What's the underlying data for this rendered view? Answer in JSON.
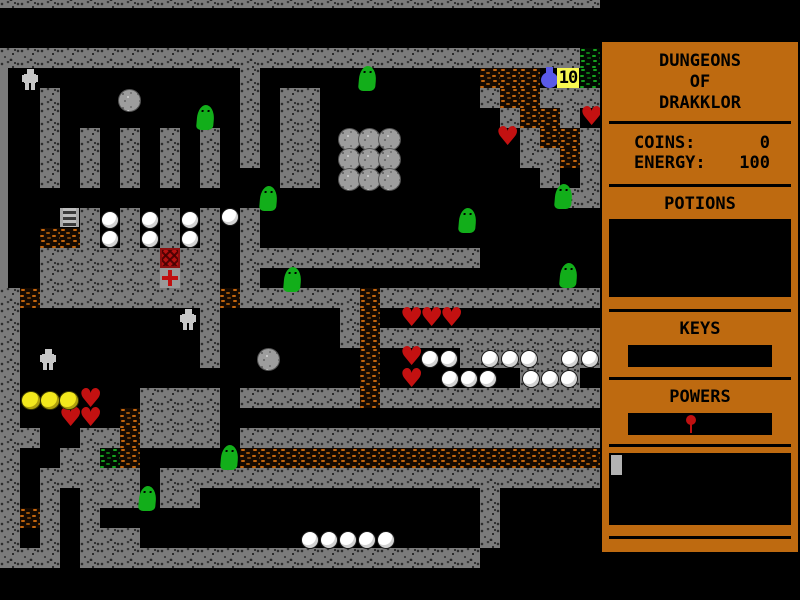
{
  "colors": {
    "panel_bg": "#BE6A10",
    "wall_gray": "#7B7B7B",
    "dirt_orange": "#C4660E",
    "moss_green": "#16A31E",
    "heart_red": "#C31111",
    "slime_green": "#12AE1A",
    "coin_yellow": "#F2E81D",
    "flask_blue": "#5A5AE8",
    "badge_bg": "#F8F850"
  },
  "game": {
    "tile_size": 20,
    "origin_y_offset": -12,
    "legend": {
      "#": "wall",
      ".": "floor",
      "d": "dirt",
      "m": "moss",
      "h": "wall-edge",
      "X": "chest-red",
      "+": "cross-arrows"
    },
    "map": [
      "##############################",
      "..............................",
      "..............................",
      "#############################m",
      "h...........#...........ddd..m",
      "h.#.........#.##........#dd###",
      "h.#.........#.##.........#dd#.",
      "h.#.#.#.#.#.#.##..........#dd#",
      "h.#.#.#.#.#.#.##..........##d#",
      "h.#.#.#.#.#...##...........#.#",
      "h...........................##",
      "h...#.#.#.#.#.................",
      "h.dd#.#.#.#.#.................",
      "h.######X##.############......",
      "h.######+##.#.................",
      "#d#########d######d###########",
      "#.........#......#d...........",
      "#.........#......#d###########",
      "#.........#.......d....#######",
      "#.................d.......###.",
      "#......####.######d###########",
      "#.....d####...................",
      "##..##d####.##################",
      "#..##md.....dddddddddddddddddd",
      "#.#####.######################",
      "#.#.###.##..............#.....",
      "#d#.#...................#.....",
      "#.#.###.................#.....",
      "###.####################......"
    ],
    "sprites": [
      {
        "type": "golem",
        "x": 22,
        "y": 69
      },
      {
        "type": "golem",
        "x": 180,
        "y": 309
      },
      {
        "type": "golem",
        "x": 40,
        "y": 349
      },
      {
        "type": "slime",
        "x": 359,
        "y": 66
      },
      {
        "type": "slime",
        "x": 197,
        "y": 105
      },
      {
        "type": "slime",
        "x": 260,
        "y": 186
      },
      {
        "type": "slime",
        "x": 459,
        "y": 208
      },
      {
        "type": "slime",
        "x": 555,
        "y": 184
      },
      {
        "type": "slime",
        "x": 284,
        "y": 267
      },
      {
        "type": "slime",
        "x": 560,
        "y": 263
      },
      {
        "type": "slime",
        "x": 221,
        "y": 445
      },
      {
        "type": "slime",
        "x": 139,
        "y": 486
      },
      {
        "type": "boulder",
        "x": 118,
        "y": 89
      },
      {
        "type": "boulder",
        "x": 257,
        "y": 348
      },
      {
        "type": "boulder",
        "x": 338,
        "y": 128
      },
      {
        "type": "boulder",
        "x": 358,
        "y": 128
      },
      {
        "type": "boulder",
        "x": 378,
        "y": 128
      },
      {
        "type": "boulder",
        "x": 338,
        "y": 148
      },
      {
        "type": "boulder",
        "x": 358,
        "y": 148
      },
      {
        "type": "boulder",
        "x": 378,
        "y": 148
      },
      {
        "type": "boulder",
        "x": 338,
        "y": 168
      },
      {
        "type": "boulder",
        "x": 358,
        "y": 168
      },
      {
        "type": "boulder",
        "x": 378,
        "y": 168
      },
      {
        "type": "heart",
        "x": 580,
        "y": 108
      },
      {
        "type": "heart",
        "x": 496,
        "y": 128
      },
      {
        "type": "heart",
        "x": 400,
        "y": 309
      },
      {
        "type": "heart",
        "x": 420,
        "y": 309
      },
      {
        "type": "heart",
        "x": 440,
        "y": 309
      },
      {
        "type": "heart",
        "x": 400,
        "y": 348
      },
      {
        "type": "heart",
        "x": 400,
        "y": 370
      },
      {
        "type": "heart",
        "x": 79,
        "y": 390
      },
      {
        "type": "heart",
        "x": 59,
        "y": 409
      },
      {
        "type": "heart",
        "x": 79,
        "y": 409
      },
      {
        "type": "coin",
        "x": 21,
        "y": 391
      },
      {
        "type": "coin",
        "x": 40,
        "y": 391
      },
      {
        "type": "coin",
        "x": 59,
        "y": 391
      },
      {
        "type": "pearl",
        "x": 101,
        "y": 211
      },
      {
        "type": "pearl",
        "x": 141,
        "y": 211
      },
      {
        "type": "pearl",
        "x": 181,
        "y": 211
      },
      {
        "type": "pearl",
        "x": 221,
        "y": 208
      },
      {
        "type": "pearl",
        "x": 101,
        "y": 230
      },
      {
        "type": "pearl",
        "x": 141,
        "y": 230
      },
      {
        "type": "pearl",
        "x": 181,
        "y": 230
      },
      {
        "type": "pearl",
        "x": 421,
        "y": 350
      },
      {
        "type": "pearl",
        "x": 440,
        "y": 350
      },
      {
        "type": "pearl",
        "x": 481,
        "y": 350
      },
      {
        "type": "pearl",
        "x": 501,
        "y": 350
      },
      {
        "type": "pearl",
        "x": 520,
        "y": 350
      },
      {
        "type": "pearl",
        "x": 561,
        "y": 350
      },
      {
        "type": "pearl",
        "x": 581,
        "y": 350
      },
      {
        "type": "pearl",
        "x": 441,
        "y": 370
      },
      {
        "type": "pearl",
        "x": 460,
        "y": 370
      },
      {
        "type": "pearl",
        "x": 479,
        "y": 370
      },
      {
        "type": "pearl",
        "x": 522,
        "y": 370
      },
      {
        "type": "pearl",
        "x": 541,
        "y": 370
      },
      {
        "type": "pearl",
        "x": 560,
        "y": 370
      },
      {
        "type": "pearl",
        "x": 301,
        "y": 531
      },
      {
        "type": "pearl",
        "x": 320,
        "y": 531
      },
      {
        "type": "pearl",
        "x": 339,
        "y": 531
      },
      {
        "type": "pearl",
        "x": 358,
        "y": 531
      },
      {
        "type": "pearl",
        "x": 377,
        "y": 531
      },
      {
        "type": "flask",
        "x": 540,
        "y": 67
      },
      {
        "type": "badge",
        "x": 557,
        "y": 68,
        "label": "10"
      },
      {
        "type": "ladder",
        "x": 60,
        "y": 208
      }
    ]
  },
  "sidebar": {
    "title_lines": [
      "DUNGEONS",
      "OF",
      "DRAKKLOR"
    ],
    "stats": [
      {
        "label": "COINS:",
        "value": "0"
      },
      {
        "label": "ENERGY:",
        "value": "100"
      }
    ],
    "potions_header": "POTIONS",
    "keys_header": "KEYS",
    "powers_header": "POWERS",
    "help_text": "PRESS H FOR HELP"
  }
}
